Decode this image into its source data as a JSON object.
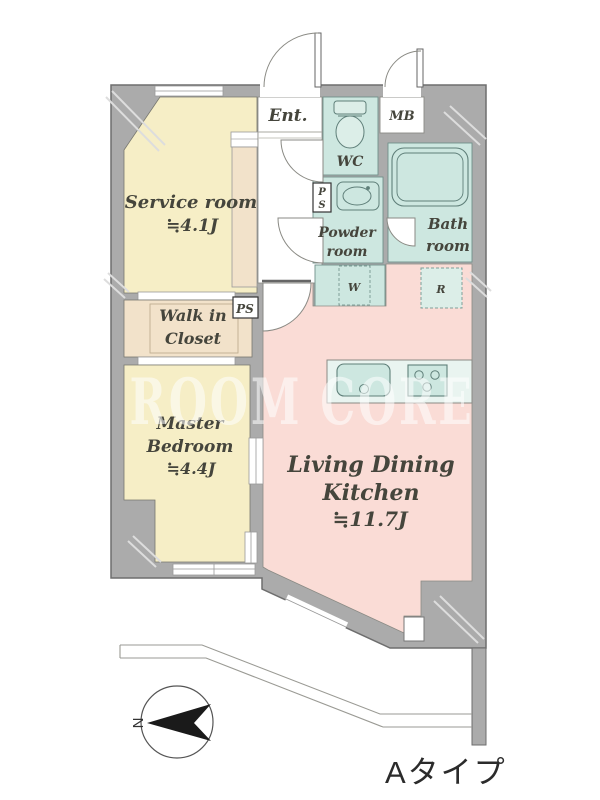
{
  "plan": {
    "entrance": "Ent.",
    "meter_box": "MB",
    "wc": "WC",
    "service_room": {
      "name": "Service room",
      "size": "≒4.1J"
    },
    "walk_in_closet": {
      "line1": "Walk in",
      "line2": "Closet"
    },
    "master_bedroom": {
      "line1": "Master",
      "line2": "Bedroom",
      "size": "≒4.4J"
    },
    "powder_room": {
      "line1": "Powder",
      "line2": "room"
    },
    "bath_room": {
      "line1": "Bath",
      "line2": "room"
    },
    "ldk": {
      "line1": "Living Dining",
      "line2": "Kitchen",
      "size": "≒11.7J"
    },
    "fixtures": {
      "washer": "W",
      "refrigerator": "R",
      "pipe_space": "PS",
      "pipe_space_p": "P",
      "pipe_space_s": "S"
    },
    "compass_north": "N",
    "plan_type": "Aタイプ",
    "watermark": "ROOM CORE",
    "colors": {
      "wall": "#ababab",
      "cream": "#f6eec6",
      "tan": "#f2e2ca",
      "mint": "#cde7e0",
      "mint_light": "#e9f4f0",
      "pink": "#fadcd6",
      "outline": "#6e6e6e",
      "text": "#45453c"
    }
  }
}
